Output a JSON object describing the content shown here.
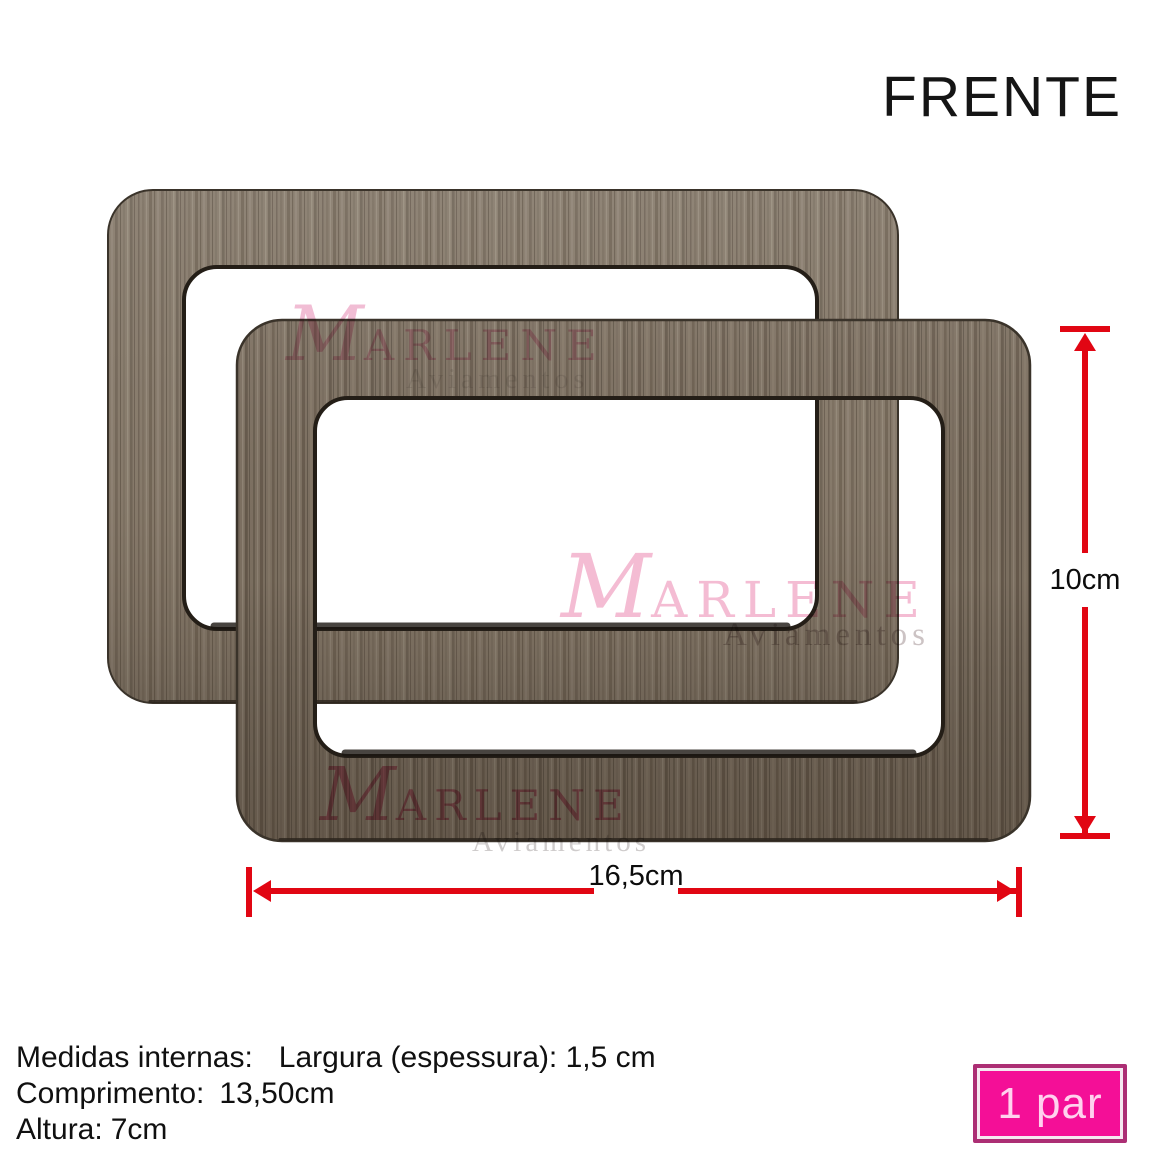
{
  "header": {
    "title": "FRENTE"
  },
  "brand": {
    "initial": "M",
    "rest": "ARLENE",
    "sub": "Aviamentos"
  },
  "dimensions": {
    "height_label": "10cm",
    "width_label": "16,5cm"
  },
  "specs": {
    "lines": [
      {
        "label": "Medidas internas:",
        "value": "Largura (espessura): 1,5 cm"
      },
      {
        "label": "Comprimento:",
        "value": "13,50cm"
      },
      {
        "label": "Altura:",
        "value": "7cm"
      }
    ]
  },
  "badge": {
    "label": "1 par"
  },
  "colors": {
    "dimension_red": "#e10613",
    "brand_pink": "#f4bcd3",
    "badge_fill": "#f40f97",
    "badge_border": "#ac2e74",
    "wood_back": "#877b6c",
    "wood_front": "#7d7061"
  }
}
